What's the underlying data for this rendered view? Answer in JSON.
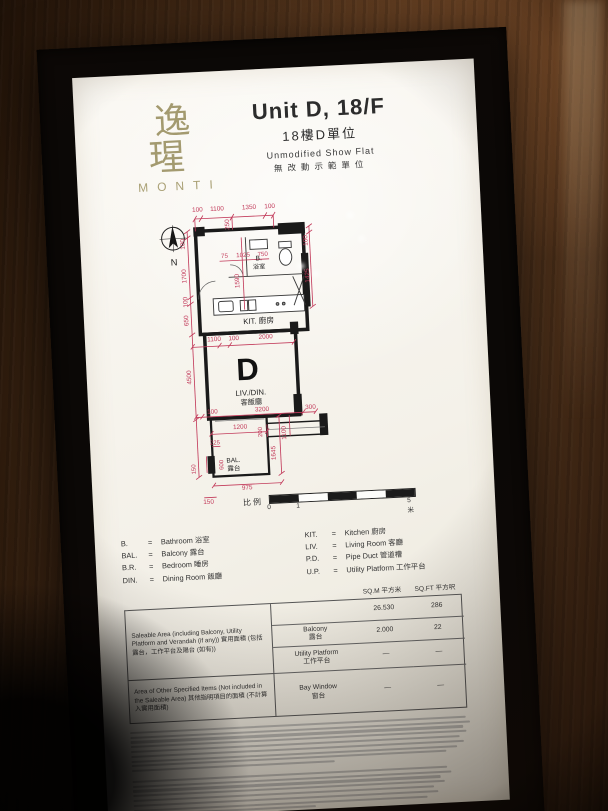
{
  "colors": {
    "dimension_line": "#c23a5a",
    "wall": "#1a1a1a",
    "logo": "#a39a6f",
    "panel_bg": "#f6f3ec"
  },
  "logo": {
    "chinese": "逸瑆",
    "latin": "MONTI"
  },
  "title": {
    "line1": "Unit D, 18/F",
    "line2": "18樓D單位",
    "line3": "Unmodified Show Flat",
    "line4": "無改動示範單位"
  },
  "plan": {
    "labels": [
      {
        "t": "N",
        "x": 22,
        "y": 64,
        "s": 9,
        "c": "room"
      },
      {
        "t": "B.",
        "x": 104,
        "y": 63,
        "s": 6.5,
        "c": "room"
      },
      {
        "t": "浴室",
        "x": 104,
        "y": 71,
        "s": 6,
        "c": "room"
      },
      {
        "t": "KIT. 廚房",
        "x": 101,
        "y": 124,
        "s": 7.5,
        "c": "room"
      },
      {
        "t": "D",
        "x": 88,
        "y": 178,
        "s": 30,
        "c": "big"
      },
      {
        "t": "LIV./DIN.",
        "x": 90,
        "y": 193,
        "s": 7.5,
        "c": "room"
      },
      {
        "t": "客飯廳",
        "x": 90,
        "y": 202,
        "s": 7,
        "c": "room"
      },
      {
        "t": "BAL.",
        "x": 70,
        "y": 257,
        "s": 6.3,
        "c": "room"
      },
      {
        "t": "露台",
        "x": 70,
        "y": 265,
        "s": 6.3,
        "c": "room"
      },
      {
        "t": "100",
        "x": 47,
        "y": 13,
        "s": 6.2,
        "c": "dim"
      },
      {
        "t": "1100",
        "x": 66,
        "y": 13,
        "s": 6.2,
        "c": "dim"
      },
      {
        "t": "1350",
        "x": 97,
        "y": 13,
        "s": 6.2,
        "c": "dim"
      },
      {
        "t": "100",
        "x": 117,
        "y": 13,
        "s": 6.2,
        "c": "dim"
      },
      {
        "t": "250",
        "x": 77,
        "y": 27,
        "s": 6.2,
        "c": "dim",
        "r": -90
      },
      {
        "t": "100",
        "x": 152,
        "y": 46,
        "s": 6.2,
        "c": "dim",
        "r": -90
      },
      {
        "t": "100",
        "x": 33,
        "y": 44,
        "s": 6.2,
        "c": "dim",
        "r": -90
      },
      {
        "t": "1700",
        "x": 33,
        "y": 75,
        "s": 6.2,
        "c": "dim",
        "r": -90
      },
      {
        "t": "100",
        "x": 33,
        "y": 100,
        "s": 6.2,
        "c": "dim",
        "r": -90
      },
      {
        "t": "650",
        "x": 33,
        "y": 118,
        "s": 6.2,
        "c": "dim",
        "r": -90
      },
      {
        "t": "75",
        "x": 71,
        "y": 59,
        "s": 6,
        "c": "dim"
      },
      {
        "t": "1025",
        "x": 89,
        "y": 59,
        "s": 6,
        "c": "dim"
      },
      {
        "t": "750",
        "x": 108,
        "y": 59,
        "s": 6,
        "c": "dim"
      },
      {
        "t": "1590",
        "x": 84,
        "y": 82,
        "s": 6.2,
        "c": "dim",
        "r": -90
      },
      {
        "t": "1425",
        "x": 152,
        "y": 80,
        "s": 6.2,
        "c": "dim",
        "r": -90
      },
      {
        "t": "1100",
        "x": 57,
        "y": 139,
        "s": 6.2,
        "c": "dim"
      },
      {
        "t": "100",
        "x": 76,
        "y": 139,
        "s": 6.2,
        "c": "dim"
      },
      {
        "t": "2000",
        "x": 107,
        "y": 139,
        "s": 6.2,
        "c": "dim"
      },
      {
        "t": "4500",
        "x": 33,
        "y": 173,
        "s": 6.2,
        "c": "dim",
        "r": -90
      },
      {
        "t": "100",
        "x": 52,
        "y": 209,
        "s": 6.2,
        "c": "dim"
      },
      {
        "t": "3200",
        "x": 100,
        "y": 209,
        "s": 6.2,
        "c": "dim"
      },
      {
        "t": "300",
        "x": 147,
        "y": 209,
        "s": 6.2,
        "c": "dim"
      },
      {
        "t": "1200",
        "x": 78,
        "y": 225,
        "s": 6.2,
        "c": "dim"
      },
      {
        "t": "200",
        "x": 99,
        "y": 229,
        "s": 5.8,
        "c": "dim",
        "r": -90
      },
      {
        "t": "1100",
        "x": 122,
        "y": 231,
        "s": 6.2,
        "c": "dim",
        "r": -90
      },
      {
        "t": "225",
        "x": 53,
        "y": 239,
        "s": 5.8,
        "c": "dim"
      },
      {
        "t": "1645",
        "x": 111,
        "y": 250,
        "s": 6.2,
        "c": "dim",
        "r": -90
      },
      {
        "t": "600",
        "x": 60,
        "y": 259,
        "s": 5.8,
        "c": "dim",
        "r": -90
      },
      {
        "t": "150",
        "x": 33,
        "y": 262,
        "s": 5.8,
        "c": "dim",
        "r": -90
      },
      {
        "t": "975",
        "x": 82,
        "y": 284,
        "s": 6.2,
        "c": "dim"
      },
      {
        "t": "150",
        "x": 44,
        "y": 296,
        "s": 6.2,
        "c": "dim"
      }
    ]
  },
  "scalebar": {
    "label": "比例",
    "tick0": "0",
    "tick1": "1",
    "tick_end": "5米",
    "segments": 5
  },
  "legend": {
    "eq": "=",
    "left": [
      {
        "abbr": "B.",
        "term": "Bathroom 浴室"
      },
      {
        "abbr": "BAL.",
        "term": "Balcony 露台"
      },
      {
        "abbr": "B.R.",
        "term": "Bedroom 睡房"
      },
      {
        "abbr": "DIN.",
        "term": "Dining Room 飯廳"
      }
    ],
    "right": [
      {
        "abbr": "KIT.",
        "term": "Kitchen 廚房"
      },
      {
        "abbr": "LIV.",
        "term": "Living Room 客廳"
      },
      {
        "abbr": "P.D.",
        "term": "Pipe Duct 管道槽"
      },
      {
        "abbr": "U.P.",
        "term": "Utility Platform 工作平台"
      }
    ]
  },
  "table": {
    "col_sqm": "SQ.M 平方米",
    "col_sqft": "SQ.FT 平方呎",
    "group1": "Saleable Area (including Balcony, Utility Platform and Verandah (if any)) 實用面積 (包括露台，工作平台及陽台 (如有))",
    "group2": "Area of Other Specified Items (Not included in the Saleable Area) 其他指明項目的面積 (不計算入實用面積)",
    "rows": {
      "saleable": {
        "item": "",
        "sqm": "26.530",
        "sqft": "286"
      },
      "balcony": {
        "item": "Balcony\n露台",
        "sqm": "2.000",
        "sqft": "22"
      },
      "utility": {
        "item": "Utility Platform\n工作平台",
        "sqm": "—",
        "sqft": "—"
      },
      "baywindow": {
        "item": "Bay Window\n窗台",
        "sqm": "—",
        "sqft": "—"
      }
    }
  },
  "notes": {
    "english_line_count": 9,
    "chinese_line_count": 8,
    "legibility": "illegible fine print"
  }
}
